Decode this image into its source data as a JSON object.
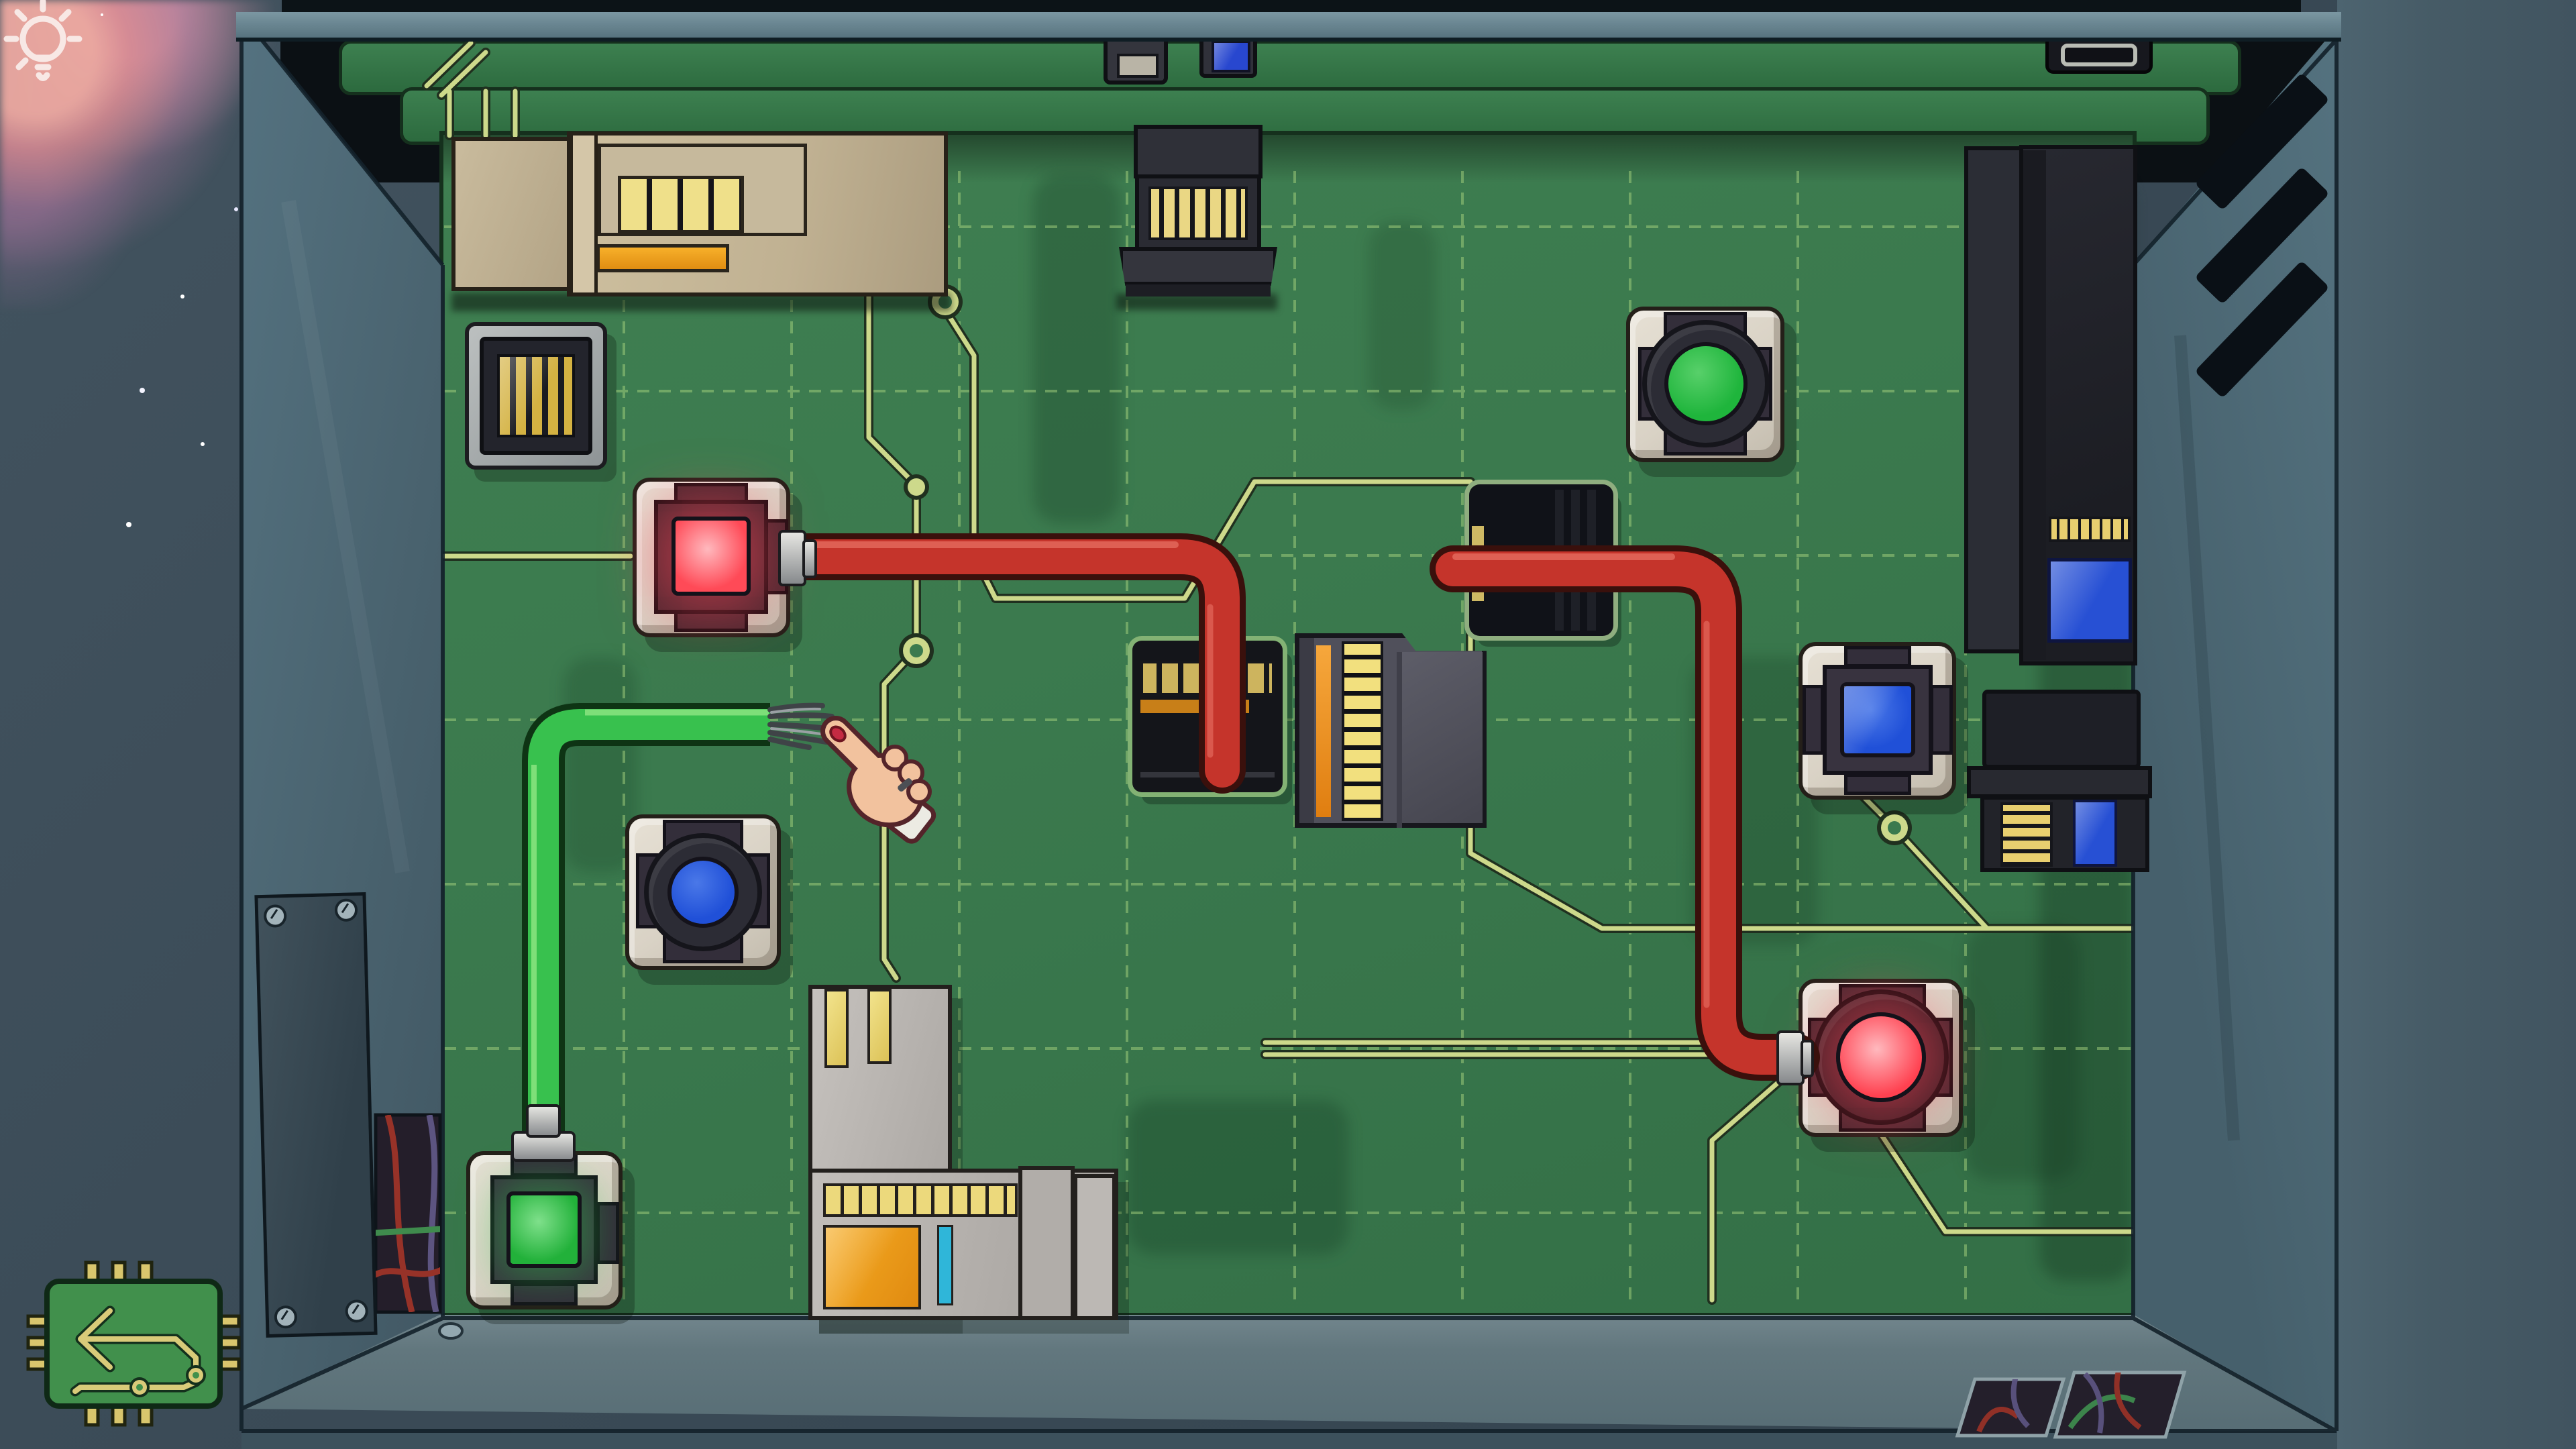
{
  "scene": {
    "name": "Circuit board room puzzle",
    "background_color": "#3a4a56",
    "board_color": "#3b7a4e",
    "wall_color": "#4e6773",
    "trace_color": "#cdd98b",
    "grid_color": "#a6d37e"
  },
  "hud": {
    "hint": {
      "icon": "lightbulb-icon",
      "label": "Hint light bulb"
    },
    "return_chip": {
      "icon": "circuit-return-chip-icon",
      "label": "Return chip button"
    }
  },
  "cursor": {
    "type": "hand-pointer",
    "label": "Hand cursor pointing at frayed green cable"
  },
  "ports": {
    "red_square": {
      "label": "Red square socket (lit)",
      "shape": "square",
      "color": "#ff4a57",
      "state": "lit"
    },
    "blue_square": {
      "label": "Blue square socket",
      "shape": "square",
      "color": "#2050d8",
      "state": "unlit"
    },
    "green_square": {
      "label": "Green square socket (lit)",
      "shape": "square",
      "color": "#22b13a",
      "state": "lit"
    },
    "green_round": {
      "label": "Green round socket",
      "shape": "round",
      "color": "#1fb53c",
      "state": "unlit"
    },
    "red_round": {
      "label": "Red round socket (lit)",
      "shape": "round",
      "color": "#ff4150",
      "state": "lit"
    },
    "blue_round": {
      "label": "Blue round socket",
      "shape": "round",
      "color": "#2050d8",
      "state": "unlit"
    }
  },
  "cables": {
    "red_cable_1": {
      "label": "Red cable from red square socket to card slot",
      "color": "#c5342b"
    },
    "red_cable_2": {
      "label": "Red cable from pass-through module to red round socket",
      "color": "#c5342b"
    },
    "green_cable": {
      "label": "Green cable with frayed cut end",
      "color": "#38c14e"
    }
  },
  "modules": {
    "beige_unit": {
      "label": "Beige reader unit with gold card slot and orange bar"
    },
    "gold_grill_port": {
      "label": "Gold contact grill port"
    },
    "top_card_module": {
      "label": "Card edge module at top"
    },
    "black_tray": {
      "label": "Black tray slot (top right)"
    },
    "usb_connector": {
      "label": "USB connector on top rail"
    },
    "blue_connector": {
      "label": "Blue connector on top rail"
    },
    "dark_tower": {
      "label": "Dark chip tower with gold contacts and blue window"
    },
    "sd_module": {
      "label": "Memory card module with gold stack and blue card"
    },
    "card_slot_module": {
      "label": "Card slot module (red cable plugged)"
    },
    "gold_edge_module": {
      "label": "Gold edge connector module"
    },
    "pass_module": {
      "label": "Pass-through module (red cable)"
    },
    "l_module": {
      "label": "Gray card module with orange label"
    },
    "wall_panel": {
      "label": "Screwed wall access panel"
    },
    "wire_recess": {
      "label": "Wall recess with loose wires"
    },
    "floor_vents": {
      "label": "Floor cable hatches"
    }
  }
}
